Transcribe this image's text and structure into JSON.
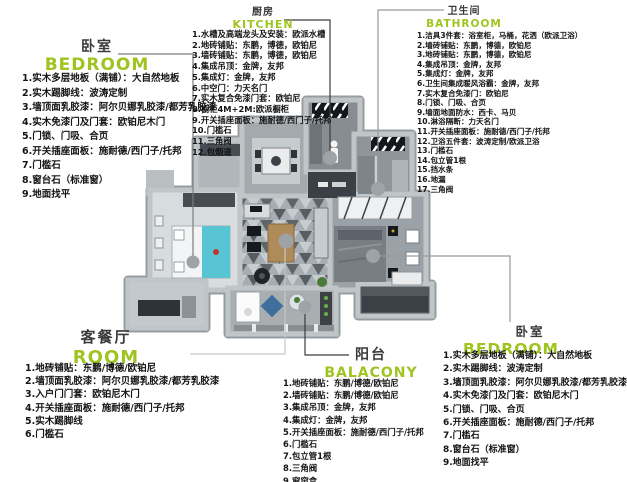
{
  "colors": {
    "accent_green": "#9fc41f",
    "text_dark": "#141414",
    "leader_dot": "#9da3a7",
    "wall_gray": "#b6bbbe",
    "bed_teal": "#57c5d3"
  },
  "zones": {
    "bedroom_tl": {
      "title_cn": "卧室",
      "title_en": "BEDROOM",
      "items": [
        "1.实木多层地板（满铺）：大自然地板",
        "2.实木踢脚线：波涛定制",
        "3.墙顶面乳胶漆：阿尔贝娜乳胶漆/都芳乳胶漆",
        "4.实木免漆门及门套：欧铂尼木门",
        "5.门锁、门吸、合页",
        "6.开关插座面板：施耐德/西门子/托邦",
        "7.门槛石",
        "8.窗台石（标准窗）",
        "9.地面找平"
      ]
    },
    "kitchen": {
      "title_cn": "厨房",
      "title_en": "KITCHEN",
      "items": [
        "1.水槽及高端龙头及安装：欧派水槽",
        "2.地砖铺贴：东鹏，博德，欧铂尼",
        "3.墙砖铺贴：东鹏，博德，欧铂尼",
        "4.集成吊顶：金牌，友邦",
        "5.集成灯：金牌，友邦",
        "6.中空门：力天名门",
        "7.实木复合免漆门套：欧铂尼",
        "8.橱柜4M+2M:欧派橱柜",
        "9.开关插座面板：施耐德/西门子/托邦",
        "10.门槛石",
        "11.三角阀",
        "12.包烟道"
      ]
    },
    "bathroom": {
      "title_cn": "卫生间",
      "title_en": "BATHROOM",
      "items": [
        "1.洁具3件套：浴室柜，马桶，花洒（欧派卫浴）",
        "2.墙砖铺贴：东鹏，博德，欧铂尼",
        "3.地砖铺贴：东鹏，博德，欧铂尼",
        "4.集成吊顶：金牌，友邦",
        "5.集成灯：金牌，友邦",
        "6.卫生间集成暖风浴霸：金牌，友邦",
        "7.实木复合免漆门：欧铂尼",
        "8.门锁、门吸、合页",
        "9.墙面地面防水：西卡、马贝",
        "10.淋浴隔断：力天名门",
        "11.开关插座面板：施耐德/西门子/托邦",
        "12.卫浴五件套：波涛定制/欧派卫浴",
        "13.门槛石",
        "14.包立管1根",
        "15.挡水条",
        "16.地漏",
        "17.三角阀"
      ]
    },
    "living": {
      "title_cn": "客餐厅",
      "title_en": "ROOM",
      "items": [
        "1.地砖铺贴：东鹏/博德/欧铂尼",
        "2.墙顶面乳胶漆：阿尔贝娜乳胶漆/都芳乳胶漆",
        "3.入户门门套：欧铂尼木门",
        "4.开关插座面板：施耐德/西门子/托邦",
        "5.实木踢脚线",
        "6.门槛石"
      ]
    },
    "balcony": {
      "title_cn": "阳台",
      "title_en": "BALACONY",
      "items": [
        "1.地砖铺贴：东鹏/博德/欧铂尼",
        "2.墙砖铺贴：东鹏/博德/欧铂尼",
        "3.集成吊顶：金牌，友邦",
        "4.集成灯：金牌，友邦",
        "5.开关插座面板：施耐德/西门子/托邦",
        "6.门槛石",
        "7.包立管1根",
        "8.三角阀",
        "9.窗帘盒"
      ]
    },
    "bedroom_br": {
      "title_cn": "卧室",
      "title_en": "BEDROOM",
      "items": [
        "1.实木多层地板（满铺）：大自然地板",
        "2.实木踢脚线：波涛定制",
        "3.墙顶面乳胶漆：阿尔贝娜乳胶漆/都芳乳胶漆",
        "4.实木免漆门及门套：欧铂尼木门",
        "5.门锁、门吸、合页",
        "6.开关插座面板：施耐德/西门子/托邦",
        "7.门槛石",
        "8.窗台石（标准窗）",
        "9.地面找平"
      ]
    }
  }
}
